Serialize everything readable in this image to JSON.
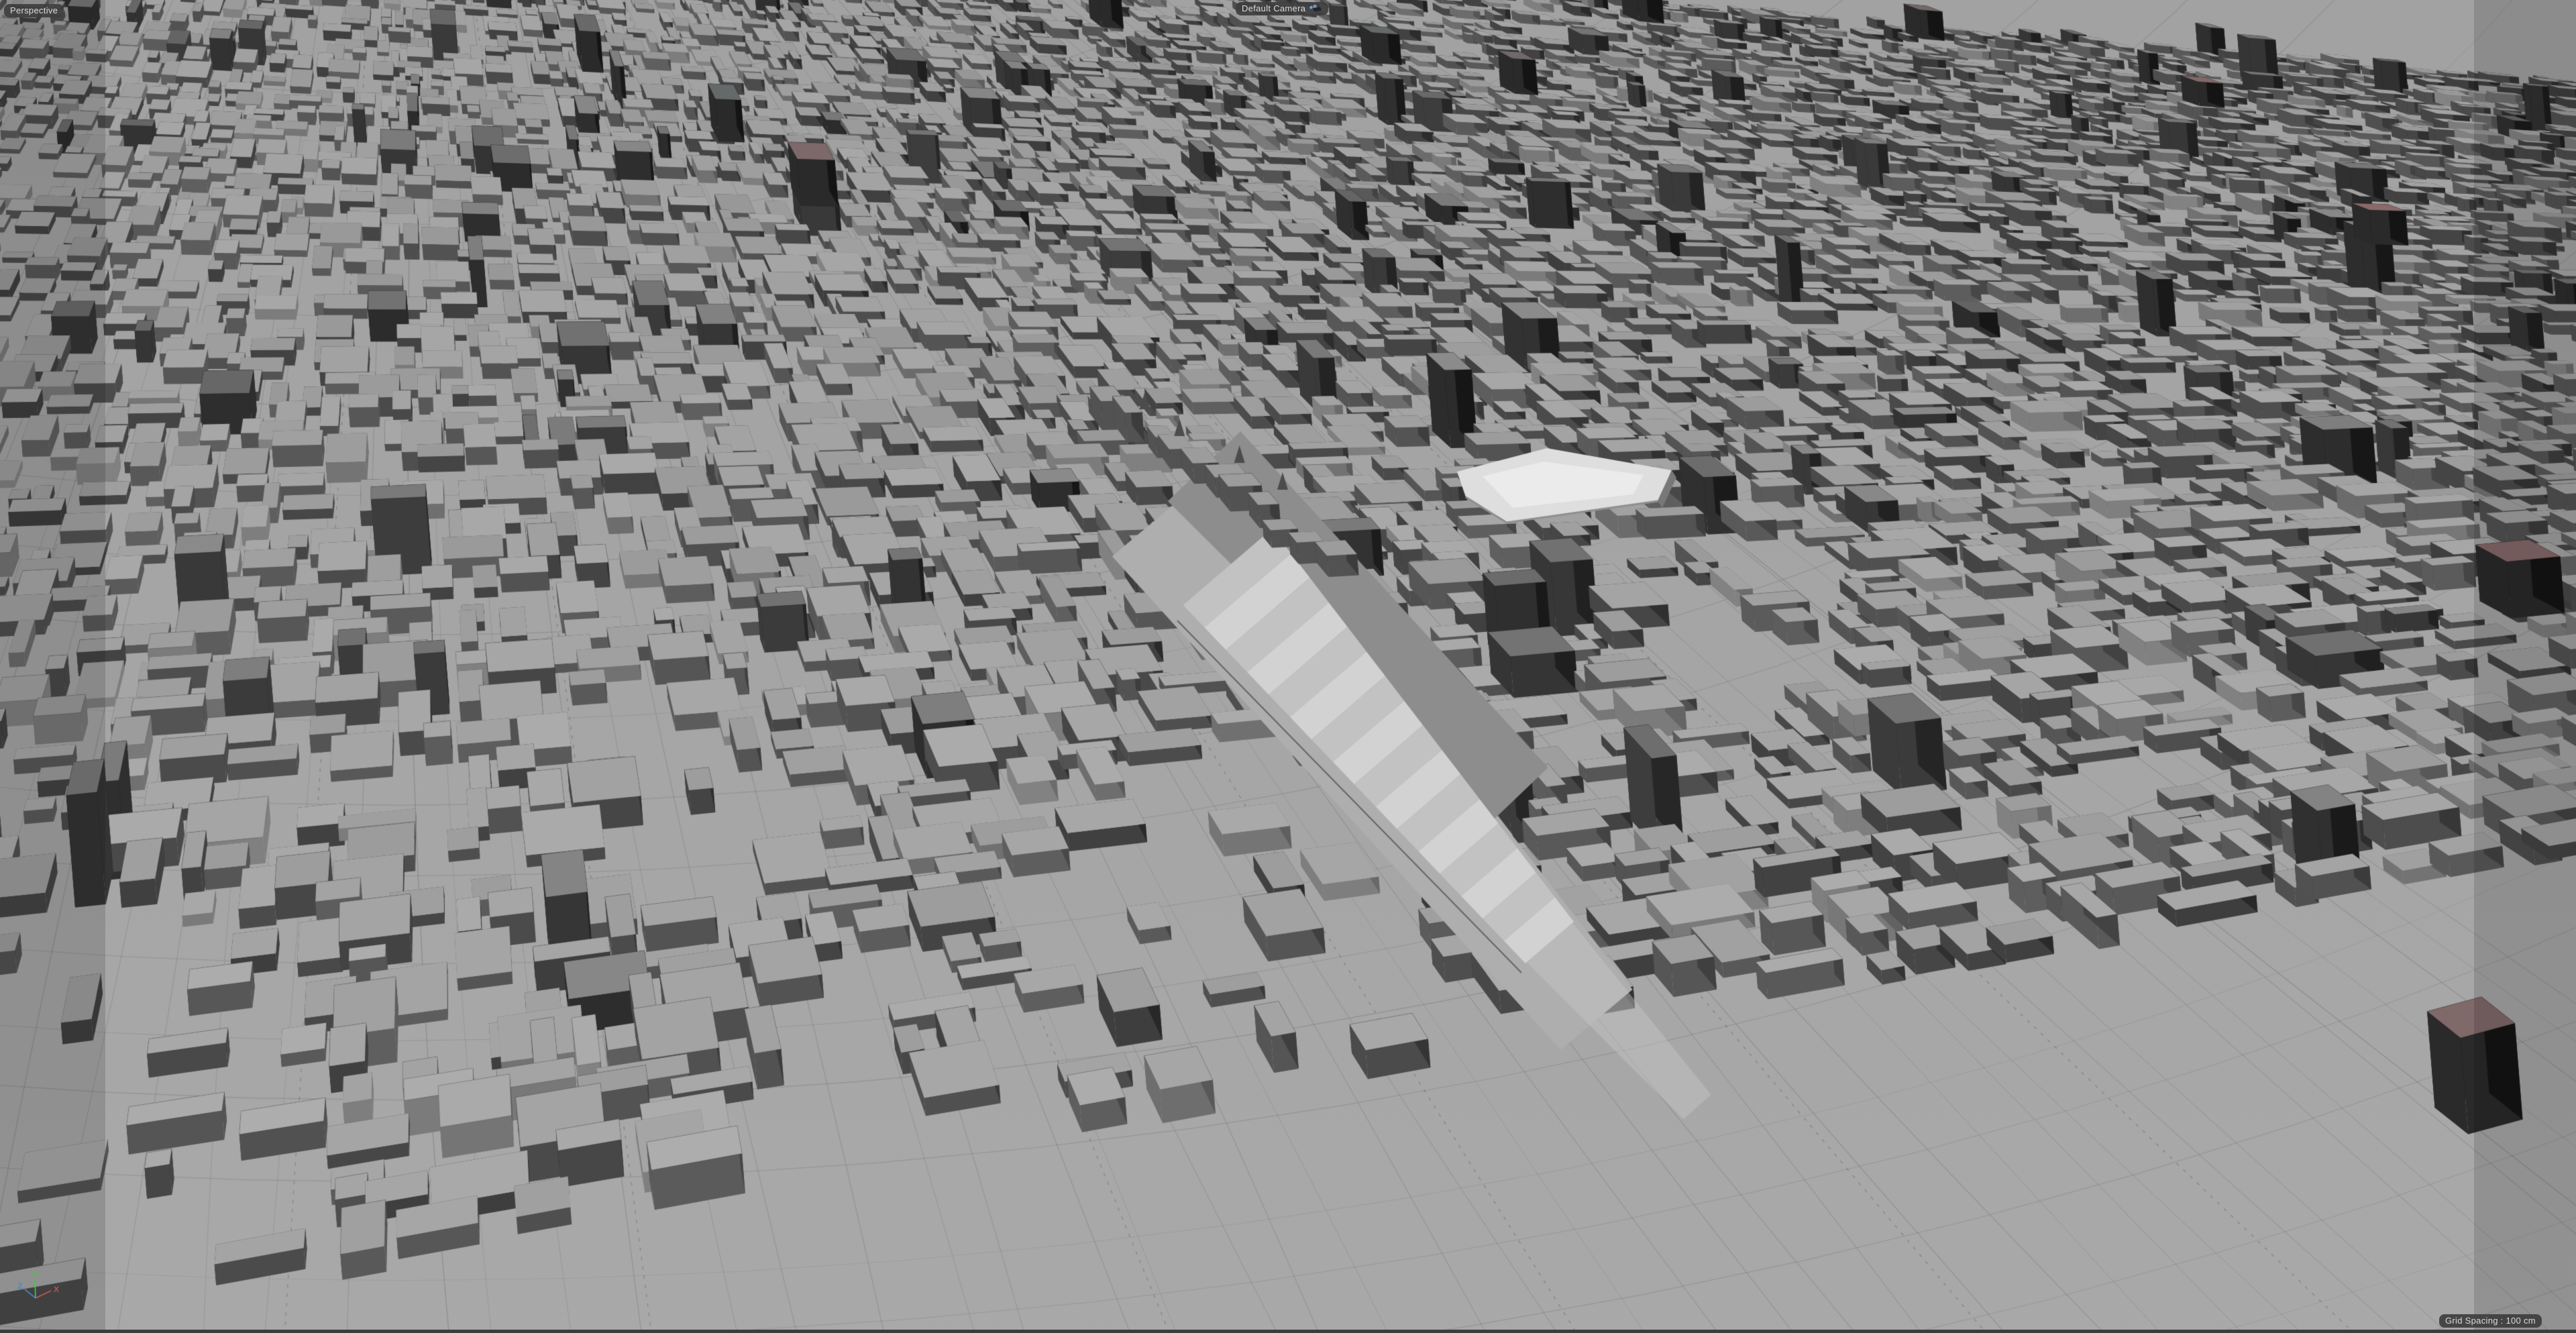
{
  "viewport": {
    "view_mode_label": "Perspective",
    "camera_label": "Default Camera",
    "grid_spacing_label": "Grid Spacing : 100 cm"
  },
  "axis_gizmo": {
    "x_label": "X",
    "y_label": "Y",
    "z_label": "Z",
    "x_color": "#c05a52",
    "y_color": "#46c24a",
    "z_color": "#4386cb"
  },
  "scene": {
    "description": "Monochrome untextured 3D city clay render viewed from a high perspective camera; dense rows of extruded gray blocks, faint curved streets, ornate station building with long rippled light roof near center and a light beveled hall beside it",
    "colors": {
      "ground_top": "#a2a2a2",
      "ground_bottom": "#a9a9a9",
      "building_top": "#9e9e9e",
      "building_side": "#383838",
      "tower_side": "#1e1e1e",
      "tower_top": "#6e6e6e",
      "road_line": "#3c3c3c",
      "station_roof_dark": "#8d8d8d",
      "station_roof_light": "#d2d2d2",
      "station_roof_light_alt": "#c2c2c2",
      "hall_roof_light": "#dedede",
      "hall_roof_highlight": "#ebebeb",
      "platform": "#aeaeae",
      "edge_band": "rgba(0,0,0,0.135)",
      "status_strip": "#3d3d3d",
      "label_bg": "rgba(62,62,62,0.92)",
      "label_text": "#dcdcdc",
      "camera_icon_dot": "#7da3d4",
      "camera_icon_body": "#242424"
    }
  }
}
